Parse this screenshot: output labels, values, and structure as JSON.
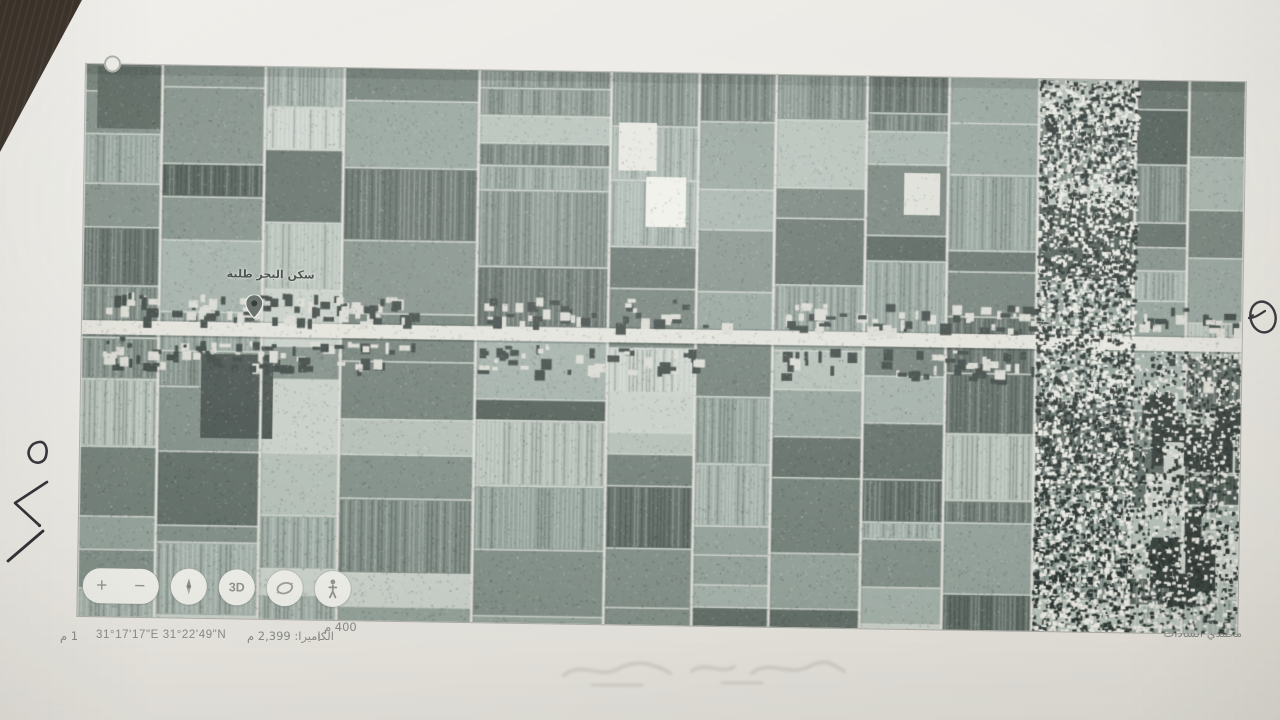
{
  "paper": {
    "handwritten_page_number": "٥٧١"
  },
  "map": {
    "pin_label": "سكن البحر طلبة"
  },
  "controls": {
    "zoom_in_label": "+",
    "zoom_out_label": "−",
    "three_d_label": "3D"
  },
  "status_bar": {
    "elevation": "1 م",
    "coordinates": "31°17'17\"E 31°22'49\"N",
    "camera_altitude": "الكاميرا: 2,399 م",
    "scale_label": "400 م"
  },
  "footer": {
    "signature": "محمدي السادات"
  },
  "colors": {
    "paper": "#eae8e3",
    "background_wood": "#241e18",
    "print_midtone": "#93a09a",
    "road": "#e3e3dc",
    "ink": "#2f2f35",
    "ui_text": "#898b86"
  }
}
